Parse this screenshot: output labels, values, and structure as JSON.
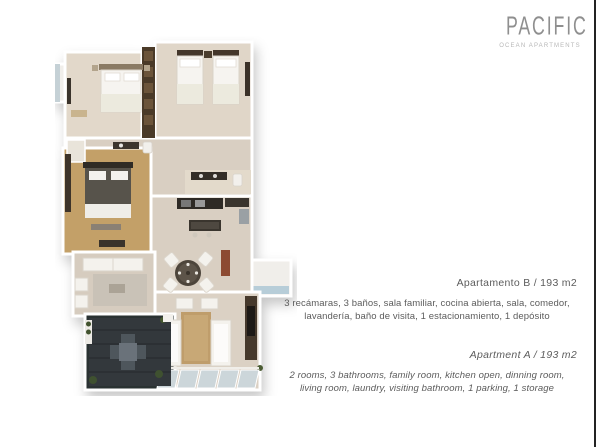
{
  "logo": {
    "title": "PACIFIC",
    "subtitle": "OCEAN APARTMENTS",
    "title_color": "#8f8f8f",
    "subtitle_color": "#b7b7b7"
  },
  "listing_es": {
    "title": "Apartamento B / 193 m2",
    "line1": "3 recámaras, 3 baños, sala familiar, cocina abierta, sala, comedor,",
    "line2": "lavandería, baño de visita, 1 estacionamiento, 1 depósito"
  },
  "listing_en": {
    "title": "Apartment A / 193 m2",
    "line1": "2 rooms, 3 bathrooms, family room, kitchen open, dinning room,",
    "line2": "living room, laundry, visiting bathroom, 1 parking, 1 storage"
  },
  "page": {
    "right_rule_color": "#232323",
    "background": "#ffffff",
    "text_color": "#5c5c5c"
  },
  "floorplan": {
    "description": "3D top-down render of apartment floor plan",
    "colors": {
      "floor_beige": "#d9cfc2",
      "floor_cream": "#e2d8ca",
      "floor_mustard": "#c3a068",
      "wall_white": "#ffffff",
      "terrace_dark": "#2c3033",
      "glass_blue": "#b7cdd8",
      "dark_wood": "#4a3a28",
      "furniture_white": "#f4f2ed",
      "rug_tan": "#bf9d6b",
      "plant_green": "#3f5130",
      "accent_red_cabinet": "#8c4a32"
    }
  }
}
